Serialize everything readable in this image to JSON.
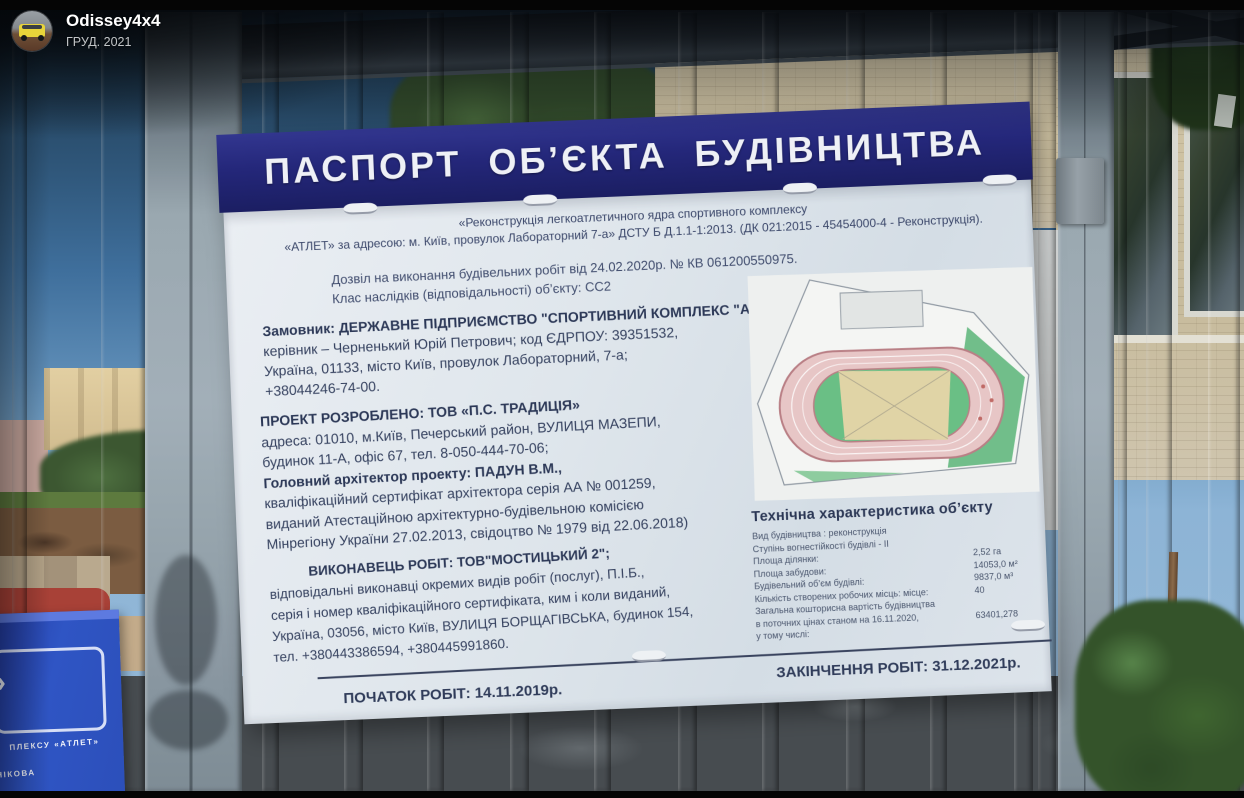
{
  "attribution": {
    "user": "Odissey4x4",
    "date": "ГРУД. 2021"
  },
  "sign": {
    "title": "ПАСПОРТ ОБ’ЄКТА БУДІВНИЦТВА",
    "intro": [
      "«Реконструкція легкоатлетичного ядра спортивного комплексу",
      "«АТЛЕТ» за адресою: м. Київ, провулок Лабораторний 7-а» ДСТУ Б Д.1.1-1:2013. (ДК 021:2015 - 45454000-4 - Реконструкція)."
    ],
    "permit": [
      "Дозвіл на виконання будівельних робіт від 24.02.2020р. № КВ 061200550975.",
      "Клас наслідків (відповідальності) об’єкту: СС2"
    ],
    "customer": [
      "Замовник: ДЕРЖАВНЕ ПІДПРИЄМСТВО \"СПОРТИВНИЙ КОМПЛЕКС \"АТЛЕТ\";",
      "керівник – Черненький Юрій Петрович; код ЄДРПОУ: 39351532,",
      "Україна, 01133, місто Київ, провулок Лабораторний, 7-а;",
      "+38044246-74-00."
    ],
    "project": [
      "ПРОЕКТ РОЗРОБЛЕНО: ТОВ «П.С. ТРАДИЦІЯ»",
      "адреса: 01010, м.Київ, Печерський район, ВУЛИЦЯ МАЗЕПИ,",
      "будинок 11-А, офіс 67, тел. 8-050-444-70-06;",
      "Головний архітектор проекту: ПАДУН В.М.,",
      "кваліфікаційний сертифікат архітектора серія АА № 001259,",
      "виданий Атестаційною архітектурно-будівельною комісією",
      "Мінрегіону України 27.02.2013, свідоцтво № 1979 від 22.06.2018)"
    ],
    "contractor": [
      "ВИКОНАВЕЦЬ РОБІТ: ТОВ\"МОСТИЦЬКИЙ 2\";",
      "відповідальні виконавці окремих видів робіт (послуг), П.І.Б.,",
      "серія і номер кваліфікаційного сертифіката, ким і коли виданий,",
      "Україна, 03056, місто Київ, ВУЛИЦЯ БОРЩАГІВСЬКА, будинок 154,",
      "тел. +380443386594, +380445991860."
    ],
    "tech": {
      "heading": "Технічна характеристика об’єкту",
      "rows": [
        {
          "label": "Вид будівництва : реконструкція",
          "value": ""
        },
        {
          "label": "Ступінь вогнестійкості будівлі - ІІ",
          "value": ""
        },
        {
          "label": "Площа ділянки:",
          "value": "2,52 га"
        },
        {
          "label": "Площа забудови:",
          "value": "14053,0 м²"
        },
        {
          "label": "Будівельний об’єм будівлі:",
          "value": "9837,0 м³"
        },
        {
          "label": "Кількість створених робочих місць: місце:",
          "value": "40"
        },
        {
          "label": "Загальна кошторисна вартість будівництва",
          "value": ""
        },
        {
          "label": "в поточних цінах станом на 16.11.2020,",
          "value": "63401,278"
        },
        {
          "label": "у тому числі:",
          "value": ""
        }
      ]
    },
    "start_date": "ПОЧАТОК РОБІТ: 14.11.2019р.",
    "end_date": "ЗАКІНЧЕННЯ РОБІТ: 31.12.2021р."
  },
  "side_sign": {
    "chevron": "»",
    "line1": "ПЛЕКСУ «АТЛЕТ»",
    "line2": "НІКОВА"
  },
  "colors": {
    "band_navy": "#24277a",
    "board_white": "#dfe6ec",
    "text_ink": "#35415f",
    "sky_top": "#16222e",
    "sky_bottom": "#8db4d6",
    "bar_grey": "#8c99a2",
    "track_red": "#a84137",
    "plan_track_pink": "#e7c6c6",
    "plan_green": "#63b87e",
    "plan_infield": "#e0d4a6",
    "side_sign_blue": "#2f55c4",
    "avatar_car_yellow": "#e8d43a"
  }
}
